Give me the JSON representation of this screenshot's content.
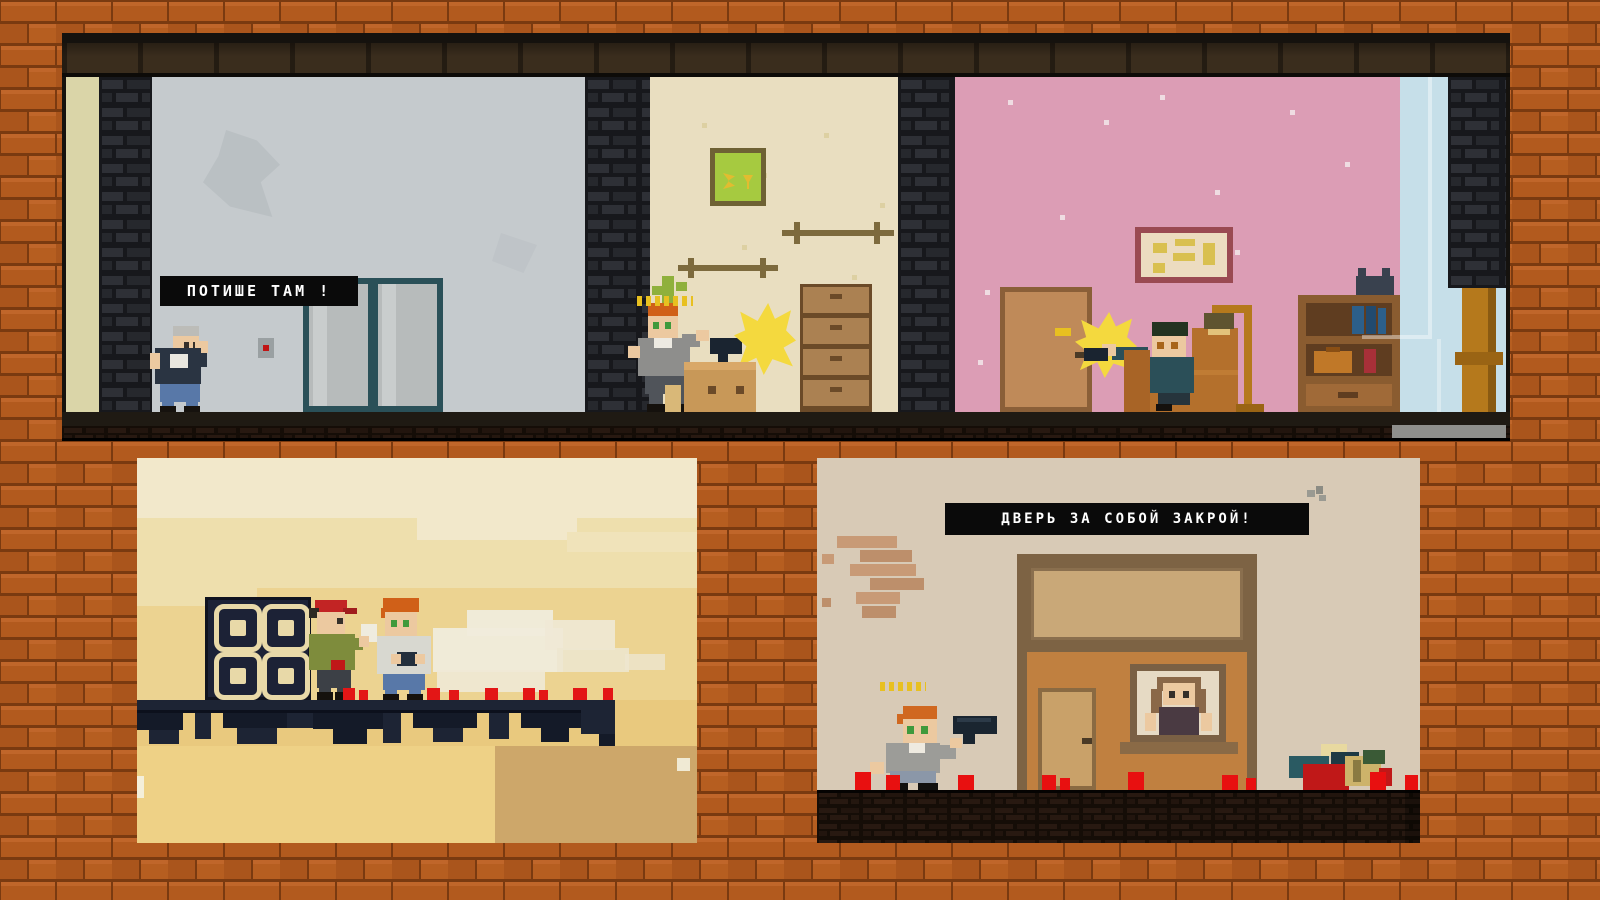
{
  "app": {
    "type": "pixel-art-game-screenshot-collage"
  },
  "text": {
    "apartment_speech_bubble": "ПОТИШЕ ТАМ !",
    "street_banner": "ДВЕРЬ ЗА СОБОЙ ЗАКРОЙ!"
  },
  "colors": {
    "brick_wall": "#b25a1e",
    "brick_mortar": "#7a3a10",
    "room_gray_wall": "#c5cacd",
    "room_beige_wall": "#e9dec0",
    "room_pink_wall": "#dc9db5",
    "outside_sky": "#c6dfe9",
    "sunset_sky_top": "#f2e8cb",
    "sunset_sky_bottom": "#e9c97e",
    "street_wall": "#d8cab6",
    "speech_bubble_bg": "#0a0a0a",
    "speech_bubble_text": "#ffffff",
    "muzzle_flash": "#f4d93e",
    "blood": "#e01414",
    "platform_steel": "#1c2232",
    "house_wood": "#c08040"
  }
}
